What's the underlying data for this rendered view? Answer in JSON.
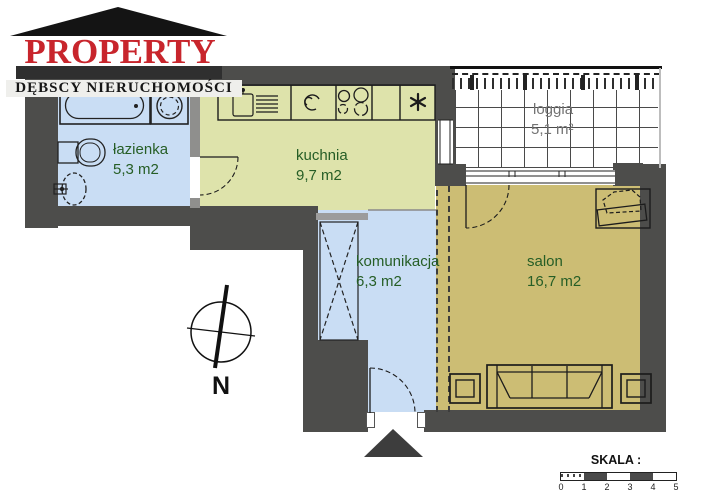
{
  "logo": {
    "brand": "PROPERTY",
    "subtitle": "DĘBSCY NIERUCHOMOŚCI",
    "brand_color": "#c8252c"
  },
  "rooms": [
    {
      "label": "łazienka",
      "area": "5,3 m2"
    },
    {
      "label": "kuchnia",
      "area": "9,7 m2"
    },
    {
      "label": "komunikacja",
      "area": "6,3 m2"
    },
    {
      "label": "salon",
      "area": "16,7 m2"
    },
    {
      "label": "loggia",
      "area": "5,1 m²"
    }
  ],
  "compass": {
    "north_label": "N"
  },
  "scale_bar": {
    "title": "SKALA :",
    "ticks": [
      "0",
      "1",
      "2",
      "3",
      "4",
      "5"
    ]
  },
  "colors": {
    "wall": "#4d4d4b",
    "wet_room_floor": "#c9ddf4",
    "kitchen_floor": "#dee3ab",
    "salon_floor": "#ccbd74",
    "room_label_green": "#265e26",
    "loggia_label_gray": "#737373",
    "logo_red": "#c8252c"
  }
}
